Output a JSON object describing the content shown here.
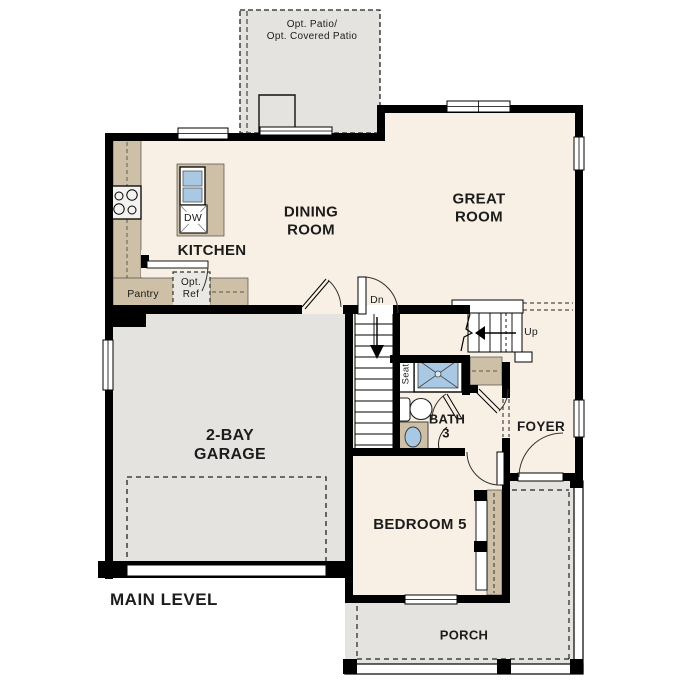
{
  "plan_title": "MAIN LEVEL",
  "rooms": {
    "patio": {
      "label": "Opt. Patio/\nOpt. Covered Patio"
    },
    "kitchen": {
      "label": "KITCHEN"
    },
    "dining": {
      "label": "DINING\nROOM"
    },
    "great": {
      "label": "GREAT\nROOM"
    },
    "garage": {
      "label": "2-BAY\nGARAGE"
    },
    "bedroom5": {
      "label": "BEDROOM 5"
    },
    "bath3": {
      "label": "BATH",
      "number": "3"
    },
    "foyer": {
      "label": "FOYER"
    },
    "porch": {
      "label": "PORCH"
    },
    "pantry": {
      "label": "Pantry"
    }
  },
  "fixtures": {
    "dishwasher": "DW",
    "optional_refrigerator": "Opt.\nRef",
    "shower_seat": "Seat",
    "stairs_down": "Dn",
    "stairs_up": "Up"
  },
  "colors": {
    "wall": "#000000",
    "interior_floor": "#f8f0e5",
    "concrete_gray": "#e5e3e0",
    "cabinet_tan": "#cec0a6",
    "fixture_blue": "#a9c8e4"
  }
}
